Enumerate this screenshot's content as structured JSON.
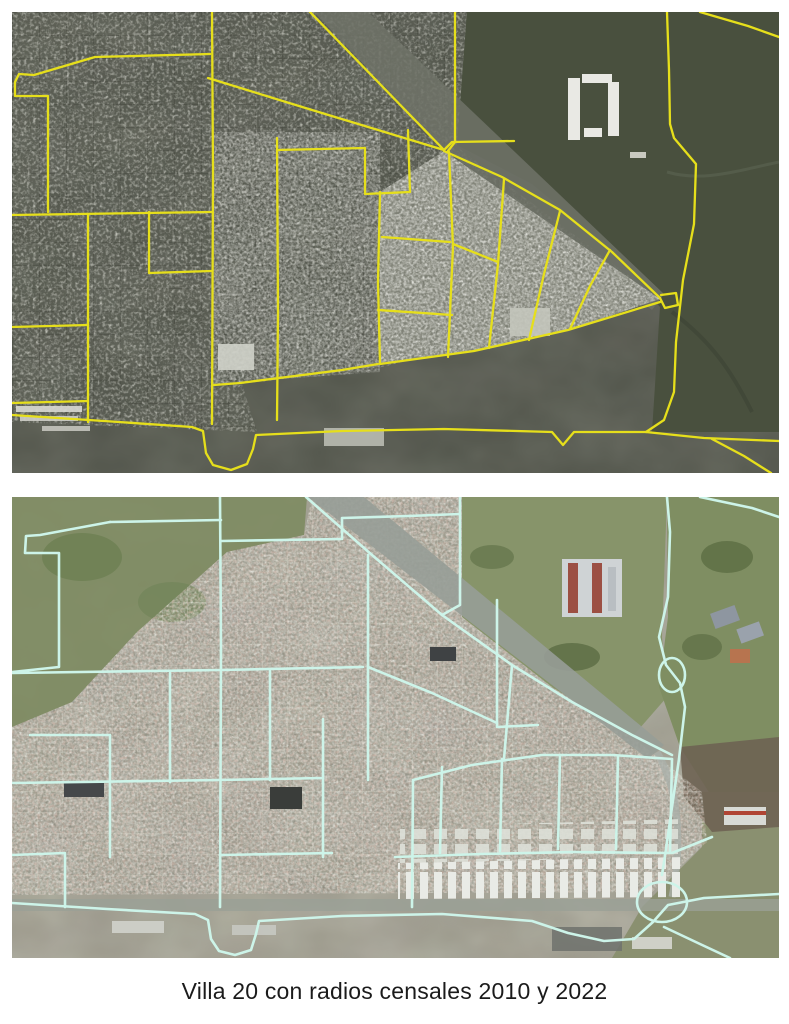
{
  "caption": "Villa 20 con radios censales 2010 y 2022",
  "panels": {
    "map2010": {
      "overlay_color": "#e6df1b",
      "polylines": [
        [
          [
            200,
            0
          ],
          [
            201,
            160
          ],
          [
            200,
            412
          ]
        ],
        [
          [
            83,
            45
          ],
          [
            198,
            42
          ]
        ],
        [
          [
            83,
            45
          ],
          [
            22,
            63
          ],
          [
            7,
            62
          ],
          [
            3,
            70
          ],
          [
            3,
            84
          ],
          [
            36,
            84
          ],
          [
            36,
            200
          ]
        ],
        [
          [
            0,
            203
          ],
          [
            200,
            200
          ]
        ],
        [
          [
            0,
            315
          ],
          [
            76,
            313
          ]
        ],
        [
          [
            76,
            203
          ],
          [
            76,
            410
          ]
        ],
        [
          [
            0,
            391
          ],
          [
            76,
            389
          ]
        ],
        [
          [
            137,
            200
          ],
          [
            137,
            261
          ],
          [
            199,
            259
          ]
        ],
        [
          [
            265,
            126
          ],
          [
            266,
            300
          ],
          [
            265,
            408
          ]
        ],
        [
          [
            265,
            138
          ],
          [
            353,
            136
          ]
        ],
        [
          [
            353,
            136
          ],
          [
            353,
            182
          ],
          [
            398,
            180
          ]
        ],
        [
          [
            396,
            118
          ],
          [
            398,
            180
          ]
        ],
        [
          [
            196,
            66
          ],
          [
            300,
            98
          ],
          [
            432,
            138
          ]
        ],
        [
          [
            298,
            0
          ],
          [
            432,
            138
          ]
        ],
        [
          [
            443,
            0
          ],
          [
            443,
            130
          ],
          [
            436,
            139
          ]
        ],
        [
          [
            432,
            138
          ],
          [
            440,
            130
          ],
          [
            502,
            129
          ]
        ],
        [
          [
            432,
            139
          ],
          [
            490,
            165
          ],
          [
            548,
            198
          ],
          [
            600,
            240
          ],
          [
            648,
            286
          ]
        ],
        [
          [
            648,
            290
          ],
          [
            556,
            318
          ],
          [
            462,
            339
          ],
          [
            368,
            352
          ]
        ],
        [
          [
            368,
            180
          ],
          [
            366,
            270
          ],
          [
            368,
            352
          ]
        ],
        [
          [
            366,
            352
          ],
          [
            330,
            358
          ],
          [
            228,
            371
          ],
          [
            202,
            373
          ]
        ],
        [
          [
            437,
            140
          ],
          [
            441,
            235
          ],
          [
            436,
            345
          ]
        ],
        [
          [
            492,
            167
          ],
          [
            486,
            252
          ],
          [
            477,
            336
          ]
        ],
        [
          [
            548,
            199
          ],
          [
            532,
            262
          ],
          [
            517,
            328
          ]
        ],
        [
          [
            598,
            238
          ],
          [
            578,
            274
          ],
          [
            558,
            317
          ]
        ],
        [
          [
            370,
            225
          ],
          [
            438,
            230
          ]
        ],
        [
          [
            366,
            298
          ],
          [
            440,
            303
          ]
        ],
        [
          [
            441,
            232
          ],
          [
            486,
            250
          ]
        ],
        [
          [
            655,
            0
          ],
          [
            657,
            58
          ],
          [
            658,
            112
          ],
          [
            662,
            126
          ],
          [
            684,
            152
          ],
          [
            682,
            212
          ],
          [
            671,
            268
          ],
          [
            664,
            330
          ],
          [
            662,
            380
          ],
          [
            652,
            408
          ],
          [
            634,
            420
          ]
        ],
        [
          [
            648,
            286
          ],
          [
            653,
            296
          ],
          [
            666,
            293
          ],
          [
            664,
            281
          ],
          [
            649,
            283
          ]
        ],
        [
          [
            0,
            403
          ],
          [
            92,
            409
          ],
          [
            180,
            415
          ],
          [
            191,
            419
          ],
          [
            194,
            441
          ],
          [
            201,
            453
          ],
          [
            219,
            458
          ],
          [
            235,
            452
          ],
          [
            241,
            437
          ],
          [
            244,
            423
          ],
          [
            330,
            419
          ],
          [
            432,
            417
          ],
          [
            540,
            420
          ],
          [
            551,
            433
          ],
          [
            562,
            420
          ],
          [
            610,
            420
          ],
          [
            634,
            420
          ],
          [
            692,
            426
          ],
          [
            767,
            429
          ]
        ],
        [
          [
            700,
            427
          ],
          [
            732,
            444
          ],
          [
            759,
            461
          ]
        ],
        [
          [
            688,
            0
          ],
          [
            736,
            14
          ],
          [
            767,
            25
          ]
        ]
      ],
      "ellipses": []
    },
    "map2022": {
      "overlay_color": "#cdf4e9",
      "polylines": [
        [
          [
            208,
            0
          ],
          [
            209,
            150
          ],
          [
            208,
            410
          ]
        ],
        [
          [
            98,
            25
          ],
          [
            209,
            23
          ]
        ],
        [
          [
            98,
            25
          ],
          [
            28,
            38
          ],
          [
            14,
            39
          ],
          [
            13,
            56
          ],
          [
            47,
            56
          ],
          [
            47,
            170
          ],
          [
            0,
            175
          ]
        ],
        [
          [
            0,
            176
          ],
          [
            208,
            173
          ],
          [
            351,
            170
          ]
        ],
        [
          [
            158,
            176
          ],
          [
            158,
            285
          ]
        ],
        [
          [
            0,
            286
          ],
          [
            208,
            283
          ],
          [
            311,
            281
          ]
        ],
        [
          [
            98,
            238
          ],
          [
            98,
            360
          ]
        ],
        [
          [
            18,
            238
          ],
          [
            98,
            238
          ]
        ],
        [
          [
            0,
            358
          ],
          [
            53,
            356
          ],
          [
            53,
            410
          ]
        ],
        [
          [
            311,
            222
          ],
          [
            311,
            360
          ]
        ],
        [
          [
            208,
            358
          ],
          [
            320,
            356
          ]
        ],
        [
          [
            356,
            58
          ],
          [
            356,
            283
          ]
        ],
        [
          [
            401,
            283
          ],
          [
            400,
            410
          ]
        ],
        [
          [
            258,
            173
          ],
          [
            258,
            283
          ]
        ],
        [
          [
            209,
            44
          ],
          [
            330,
            42
          ],
          [
            330,
            21
          ],
          [
            397,
            19
          ]
        ],
        [
          [
            397,
            19
          ],
          [
            448,
            17
          ]
        ],
        [
          [
            448,
            0
          ],
          [
            448,
            108
          ],
          [
            430,
            118
          ]
        ],
        [
          [
            294,
            0
          ],
          [
            360,
            58
          ],
          [
            430,
            118
          ],
          [
            500,
            168
          ],
          [
            560,
            205
          ],
          [
            620,
            238
          ],
          [
            660,
            258
          ]
        ],
        [
          [
            485,
            103
          ],
          [
            485,
            230
          ],
          [
            526,
            228
          ]
        ],
        [
          [
            356,
            170
          ],
          [
            420,
            196
          ],
          [
            485,
            226
          ]
        ],
        [
          [
            500,
            168
          ],
          [
            492,
            262
          ]
        ],
        [
          [
            401,
            283
          ],
          [
            460,
            268
          ],
          [
            530,
            258
          ],
          [
            600,
            258
          ],
          [
            660,
            262
          ]
        ],
        [
          [
            430,
            270
          ],
          [
            428,
            356
          ]
        ],
        [
          [
            490,
            262
          ],
          [
            488,
            354
          ]
        ],
        [
          [
            548,
            258
          ],
          [
            546,
            352
          ]
        ],
        [
          [
            606,
            259
          ],
          [
            604,
            352
          ]
        ],
        [
          [
            660,
            262
          ],
          [
            658,
            356
          ]
        ],
        [
          [
            383,
            360
          ],
          [
            470,
            357
          ],
          [
            560,
            355
          ],
          [
            660,
            356
          ],
          [
            700,
            340
          ]
        ],
        [
          [
            655,
            0
          ],
          [
            658,
            35
          ],
          [
            656,
            100
          ],
          [
            647,
            140
          ],
          [
            654,
            168
          ],
          [
            668,
            186
          ],
          [
            673,
            210
          ],
          [
            667,
            262
          ],
          [
            660,
            310
          ],
          [
            654,
            352
          ],
          [
            650,
            378
          ]
        ],
        [
          [
            0,
            406
          ],
          [
            95,
            412
          ],
          [
            183,
            417
          ],
          [
            196,
            423
          ],
          [
            199,
            442
          ],
          [
            207,
            454
          ],
          [
            223,
            458
          ],
          [
            239,
            453
          ],
          [
            244,
            437
          ],
          [
            247,
            424
          ],
          [
            330,
            419
          ],
          [
            430,
            417
          ],
          [
            520,
            424
          ],
          [
            556,
            436
          ],
          [
            592,
            444
          ],
          [
            622,
            442
          ],
          [
            641,
            425
          ],
          [
            656,
            408
          ],
          [
            692,
            401
          ],
          [
            767,
            397
          ]
        ],
        [
          [
            652,
            430
          ],
          [
            688,
            447
          ],
          [
            718,
            461
          ]
        ],
        [
          [
            688,
            0
          ],
          [
            740,
            11
          ],
          [
            767,
            20
          ]
        ]
      ],
      "ellipses": [
        {
          "cx": 650,
          "cy": 405,
          "rx": 25,
          "ry": 20
        },
        {
          "cx": 660,
          "cy": 178,
          "rx": 13,
          "ry": 17
        }
      ]
    }
  }
}
